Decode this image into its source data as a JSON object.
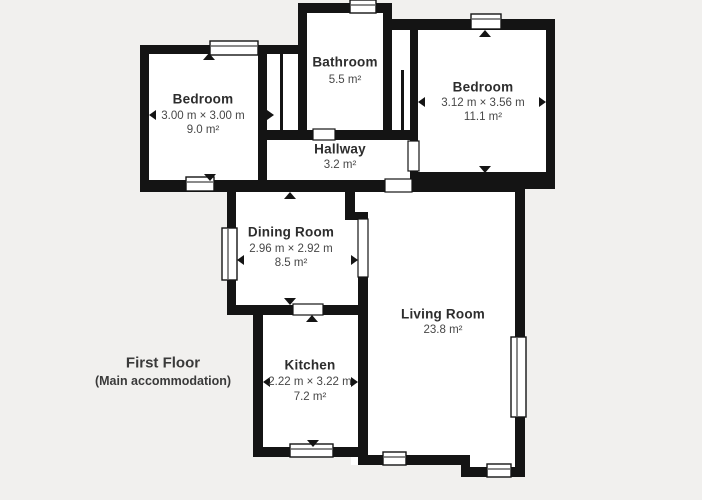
{
  "page": {
    "type": "floor-plan",
    "colors": {
      "background": "#f1f0ee",
      "wall": "#141414",
      "room_fill": "#ffffff",
      "label_text": "#2d2d2d",
      "sub_text": "#474747"
    }
  },
  "floor_label": {
    "title": "First Floor",
    "subtitle": "(Main accommodation)"
  },
  "rooms": [
    {
      "id": "bedroom-left",
      "name": "Bedroom",
      "dimensions": "3.00 m × 3.00 m",
      "area": "9.0 m²"
    },
    {
      "id": "bathroom",
      "name": "Bathroom",
      "dimensions": "",
      "area": "5.5 m²"
    },
    {
      "id": "bedroom-right",
      "name": "Bedroom",
      "dimensions": "3.12 m × 3.56 m",
      "area": "11.1 m²"
    },
    {
      "id": "hallway",
      "name": "Hallway",
      "dimensions": "",
      "area": "3.2 m²"
    },
    {
      "id": "dining-room",
      "name": "Dining Room",
      "dimensions": "2.96 m × 2.92 m",
      "area": "8.5 m²"
    },
    {
      "id": "kitchen",
      "name": "Kitchen",
      "dimensions": "2.22 m × 3.22 m",
      "area": "7.2 m²"
    },
    {
      "id": "living-room",
      "name": "Living Room",
      "dimensions": "",
      "area": "23.8 m²"
    }
  ]
}
